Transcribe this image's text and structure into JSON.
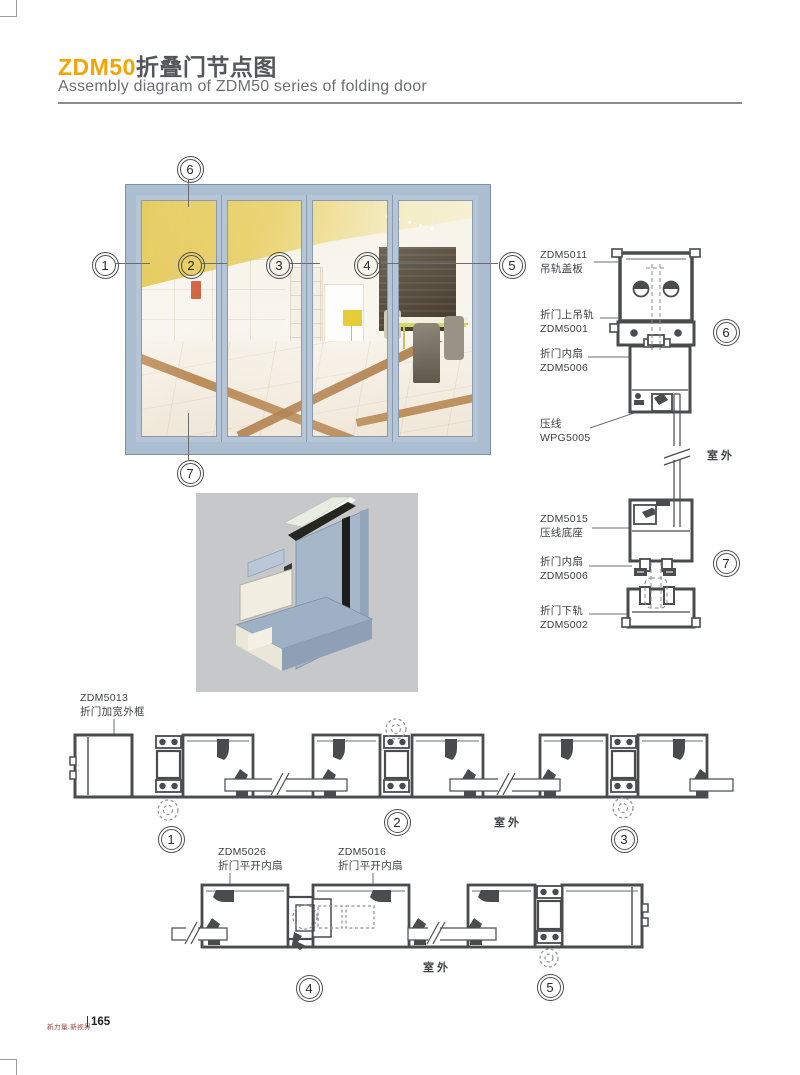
{
  "header": {
    "model": "ZDM50",
    "title_cn": "折叠门节点图",
    "subtitle": "Assembly diagram of ZDM50 series of folding door"
  },
  "footer": {
    "slogan": "新力量.新视界",
    "divider": "|",
    "page_number": "165"
  },
  "outdoor_label": "室外",
  "callout_numbers": {
    "n1": "1",
    "n2": "2",
    "n3": "3",
    "n4": "4",
    "n5": "5",
    "n6": "6",
    "n7": "7"
  },
  "right_detail_labels": {
    "l1a": "ZDM5011",
    "l1b": "吊轨盖板",
    "l2a": "折门上吊轨",
    "l2b": "ZDM5001",
    "l3a": "折门内扇",
    "l3b": "ZDM5006",
    "l4a": "压线",
    "l4b": "WPG5005",
    "l5a": "ZDM5015",
    "l5b": "压线底座",
    "l6a": "折门内扇",
    "l6b": "ZDM5006",
    "l7a": "折门下轨",
    "l7b": "ZDM5002"
  },
  "bottom_labels": {
    "frame_a": "ZDM5013",
    "frame_b": "折门加宽外框",
    "leaf1_a": "ZDM5026",
    "leaf1_b": "折门平开内扇",
    "leaf2_a": "ZDM5016",
    "leaf2_b": "折门平开内扇"
  },
  "colors": {
    "accent": "#F5A405",
    "drawing_line": "#4a4b4d",
    "frame_blue": "#aabdd1"
  }
}
